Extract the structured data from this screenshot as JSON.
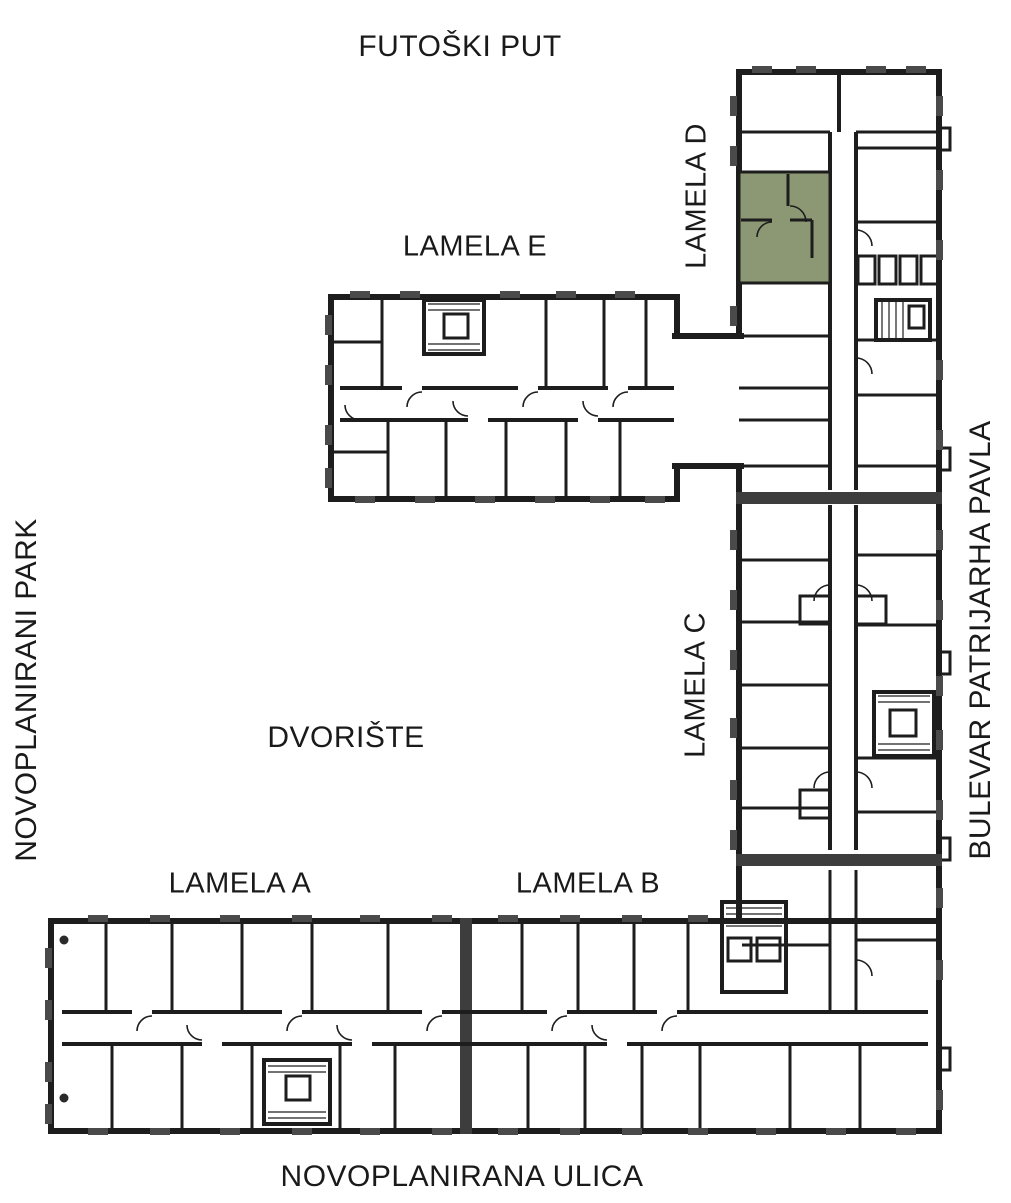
{
  "plan": {
    "title": "Site floor plan – residential complex",
    "streets": {
      "top": "FUTOŠKI PUT",
      "left": "NOVOPLANIRANI PARK",
      "right": "BULEVAR PATRIJARHA PAVLA",
      "bottom": "NOVOPLANIRANA ULICA"
    },
    "courtyard": "DVORIŠTE",
    "buildings": [
      {
        "id": "lamela-a",
        "label": "LAMELA A"
      },
      {
        "id": "lamela-b",
        "label": "LAMELA B"
      },
      {
        "id": "lamela-c",
        "label": "LAMELA C"
      },
      {
        "id": "lamela-d",
        "label": "LAMELA D"
      },
      {
        "id": "lamela-e",
        "label": "LAMELA E"
      }
    ],
    "highlight": {
      "building": "LAMELA D",
      "color": "#8b9873",
      "description": "selected apartment unit"
    },
    "colors": {
      "wall": "#1d1d1d",
      "wall_gray": "#3d3d3d",
      "window_mark": "#4a4a4a",
      "background": "#ffffff"
    }
  }
}
